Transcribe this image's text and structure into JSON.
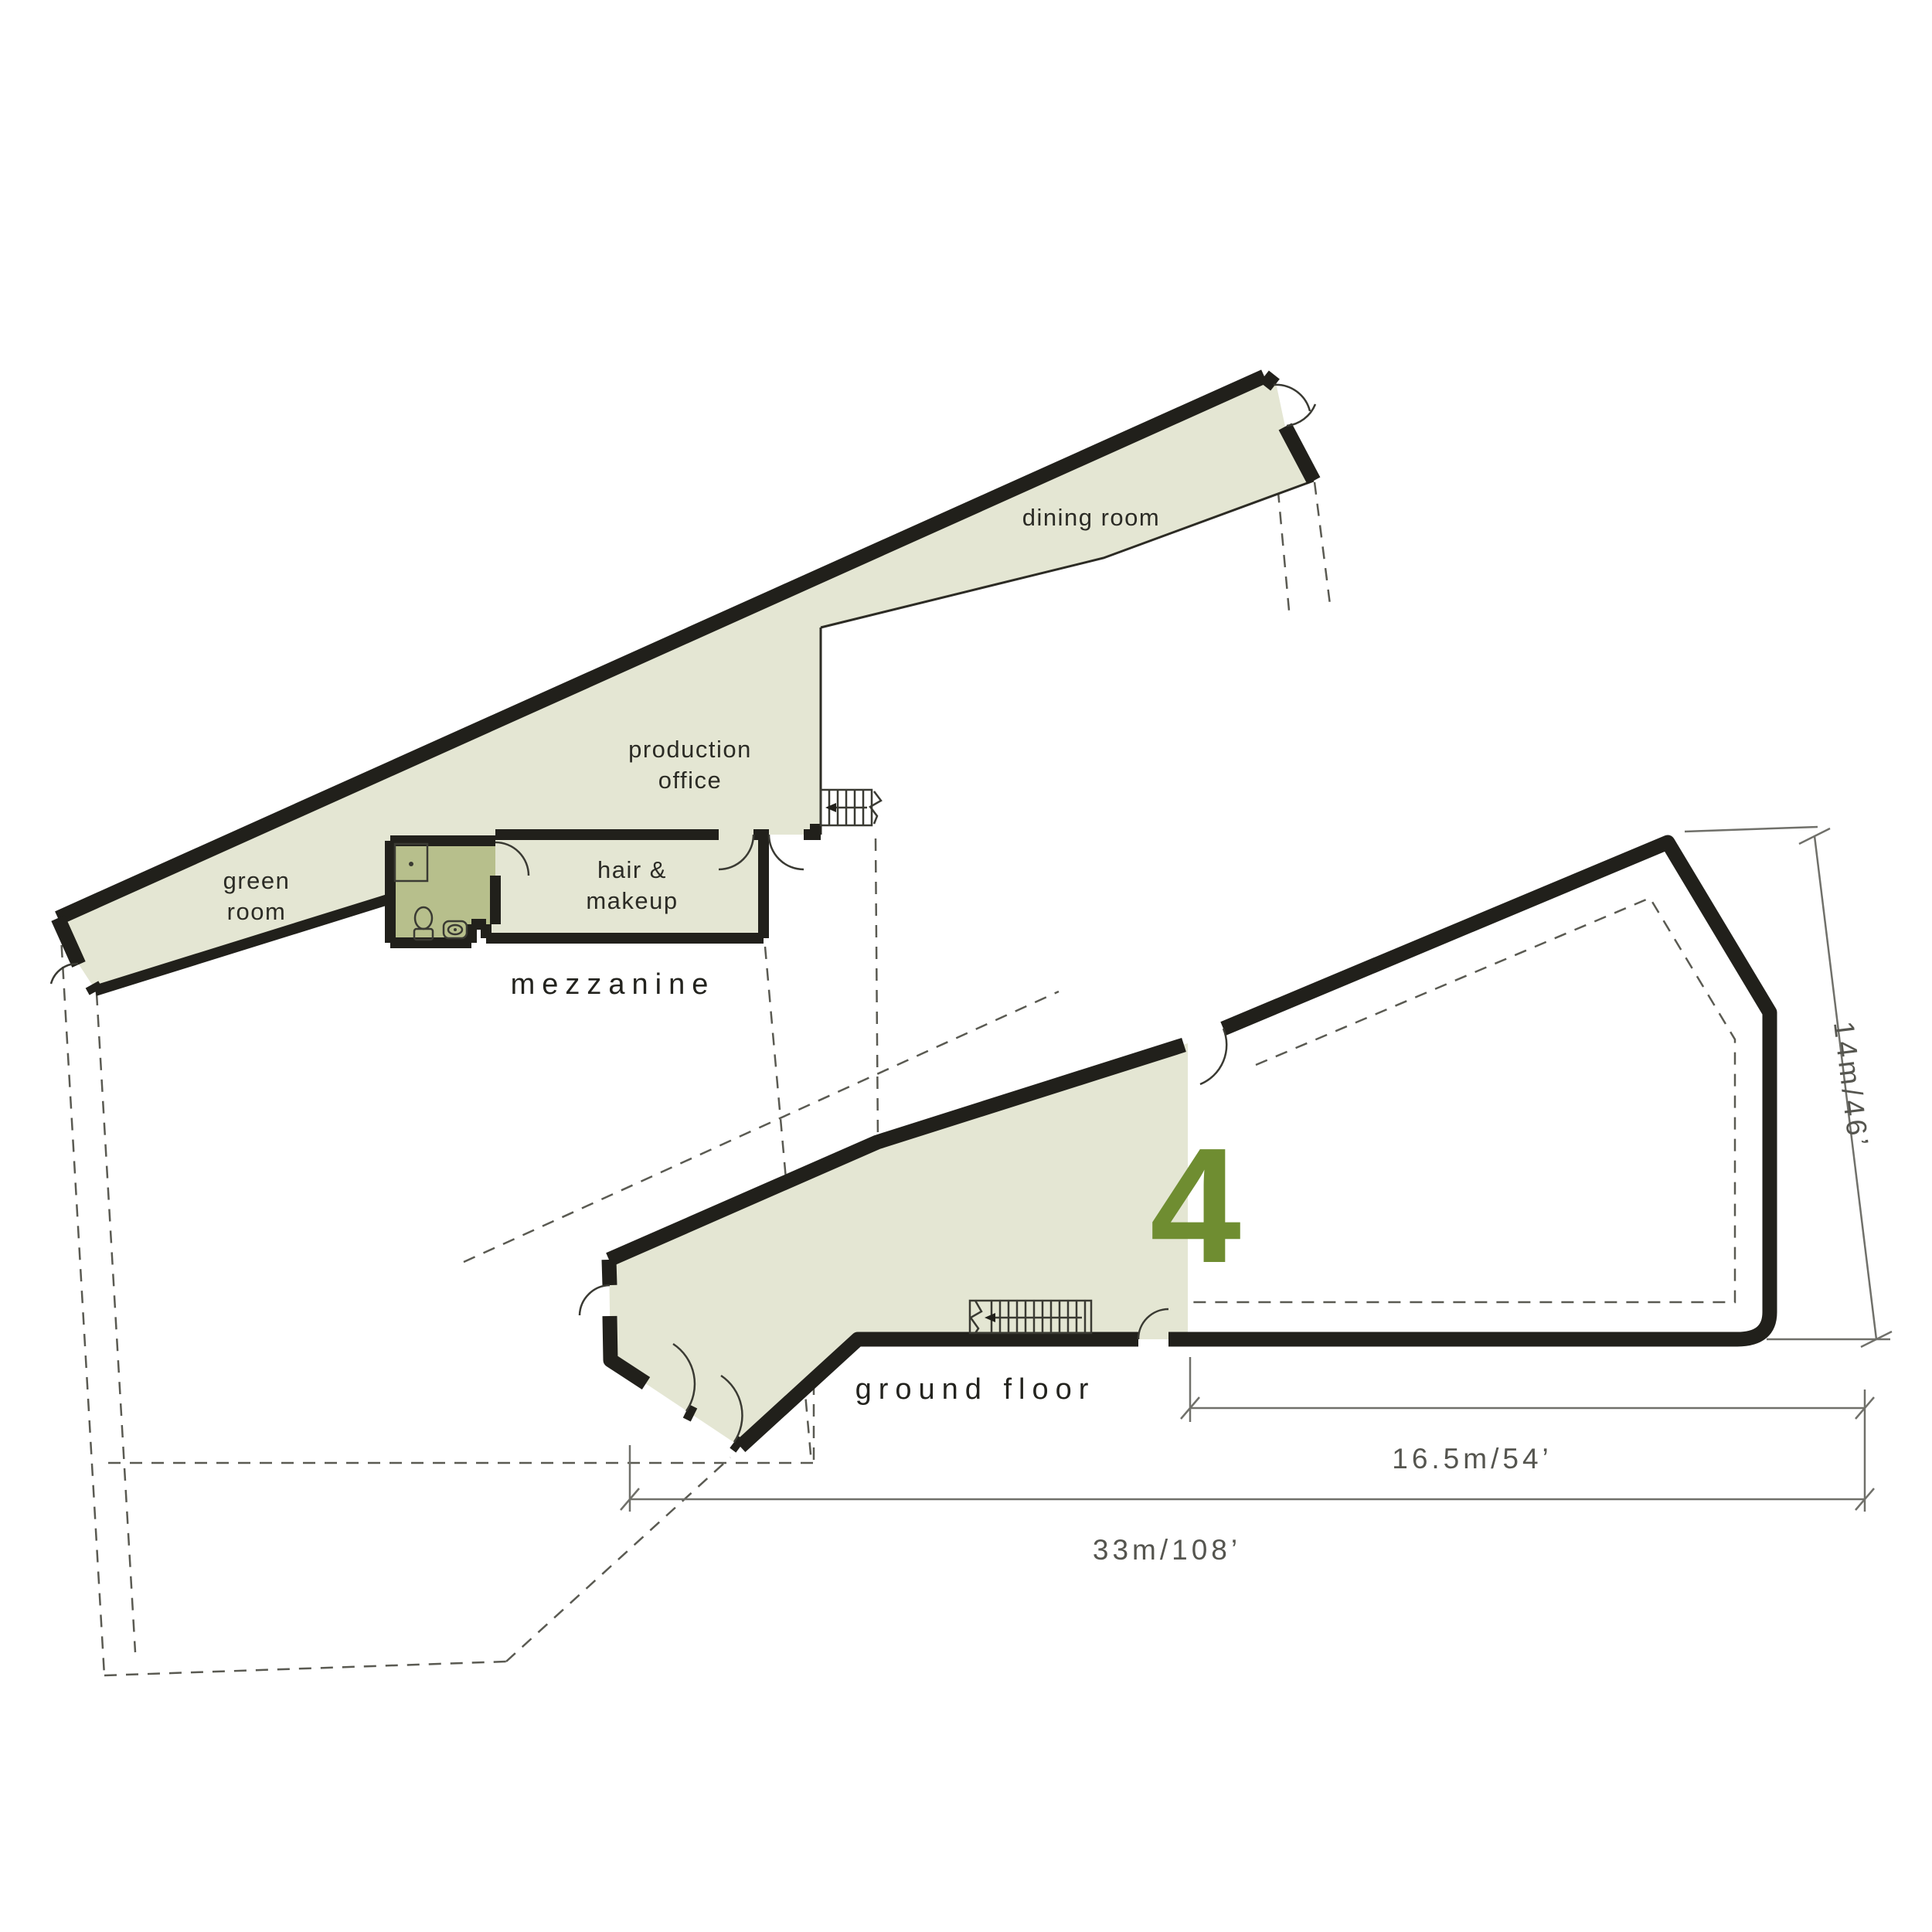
{
  "plan": {
    "mezzanine": {
      "floor_label": "mezzanine",
      "rooms": {
        "green_room": {
          "line1": "green",
          "line2": "room"
        },
        "production_office": {
          "line1": "production",
          "line2": "office"
        },
        "hair_makeup": {
          "line1": "hair &",
          "line2": "makeup"
        },
        "dining_room": {
          "label": "dining room"
        }
      }
    },
    "ground_floor": {
      "floor_label": "ground floor",
      "unit_number": "4"
    },
    "dimensions": {
      "side": "14m/46’",
      "partial": "16.5m/54’",
      "overall": "33m/108’"
    },
    "colors": {
      "room_fill": "#e4e6d3",
      "bathroom_fill": "#b7bf8c",
      "accent": "#6f8d31",
      "wall": "#21201b"
    }
  }
}
